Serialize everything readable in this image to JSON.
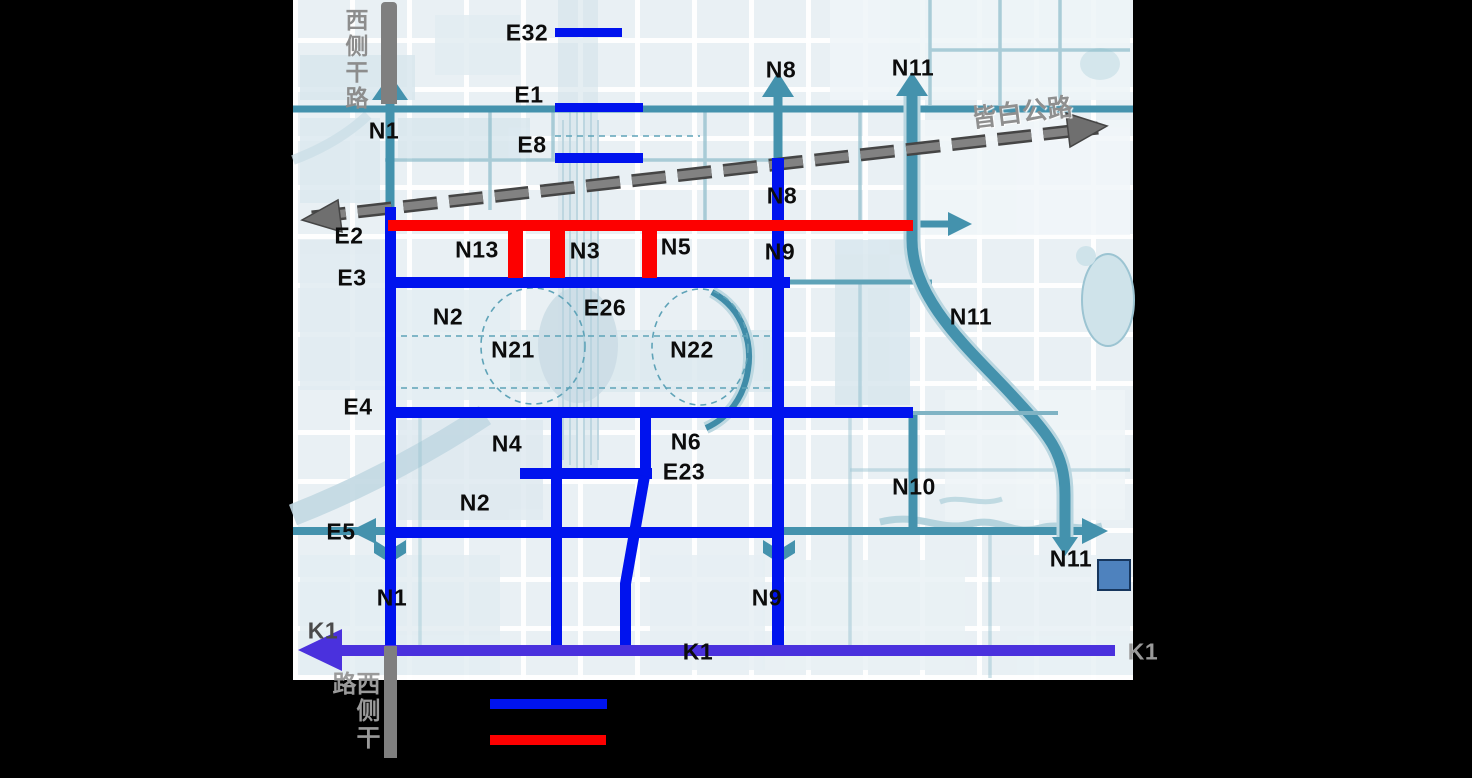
{
  "colors": {
    "road_blue": "#0013ee",
    "road_red": "#fd0000",
    "k1_purple": "#4a31dd",
    "teal": "#4492ad",
    "teal_light": "#9cc4d2",
    "gray_bar": "#7f7f7f",
    "gray_text": "#8d8d8d",
    "label_black": "#0c0c0c",
    "dashed_gray": "#6b6b6b",
    "square_fill": "#4e82be",
    "square_border": "#17365d"
  },
  "map": {
    "side_road_top": "西侧干路",
    "side_road_bottom": "西侧干路",
    "highway_name": "皆白公路",
    "labels": [
      {
        "t": "E32",
        "x": 527,
        "y": 33
      },
      {
        "t": "E1",
        "x": 529,
        "y": 95
      },
      {
        "t": "E8",
        "x": 532,
        "y": 145
      },
      {
        "t": "N1",
        "x": 384,
        "y": 131
      },
      {
        "t": "N8",
        "x": 781,
        "y": 70
      },
      {
        "t": "N11",
        "x": 913,
        "y": 68
      },
      {
        "t": "皆白公路",
        "x": 1022,
        "y": 111,
        "c": "#8f8f8f",
        "r": -7,
        "s": 25
      },
      {
        "t": "E2",
        "x": 349,
        "y": 236
      },
      {
        "t": "N13",
        "x": 477,
        "y": 250
      },
      {
        "t": "N3",
        "x": 585,
        "y": 251
      },
      {
        "t": "N5",
        "x": 676,
        "y": 247
      },
      {
        "t": "N8",
        "x": 782,
        "y": 196
      },
      {
        "t": "N9",
        "x": 780,
        "y": 252
      },
      {
        "t": "E3",
        "x": 352,
        "y": 278
      },
      {
        "t": "N2",
        "x": 448,
        "y": 317
      },
      {
        "t": "E26",
        "x": 605,
        "y": 308
      },
      {
        "t": "N21",
        "x": 513,
        "y": 350
      },
      {
        "t": "N22",
        "x": 692,
        "y": 350
      },
      {
        "t": "N11",
        "x": 971,
        "y": 317
      },
      {
        "t": "E4",
        "x": 358,
        "y": 407
      },
      {
        "t": "N4",
        "x": 507,
        "y": 444
      },
      {
        "t": "N6",
        "x": 686,
        "y": 442
      },
      {
        "t": "E23",
        "x": 684,
        "y": 472
      },
      {
        "t": "N2",
        "x": 475,
        "y": 503
      },
      {
        "t": "E5",
        "x": 341,
        "y": 532
      },
      {
        "t": "N10",
        "x": 914,
        "y": 487
      },
      {
        "t": "N11",
        "x": 1071,
        "y": 559
      },
      {
        "t": "N1",
        "x": 392,
        "y": 598
      },
      {
        "t": "N9",
        "x": 767,
        "y": 598
      },
      {
        "t": "K1",
        "x": 323,
        "y": 631,
        "c": "#4a4a4a"
      },
      {
        "t": "K1",
        "x": 698,
        "y": 652
      },
      {
        "t": "K1",
        "x": 1143,
        "y": 652,
        "c": "#9a9a9a"
      }
    ]
  },
  "legend": {
    "items": [
      {
        "name": "blue-road-line",
        "color": "#0013ee"
      },
      {
        "name": "red-road-line",
        "color": "#fd0000"
      }
    ]
  }
}
